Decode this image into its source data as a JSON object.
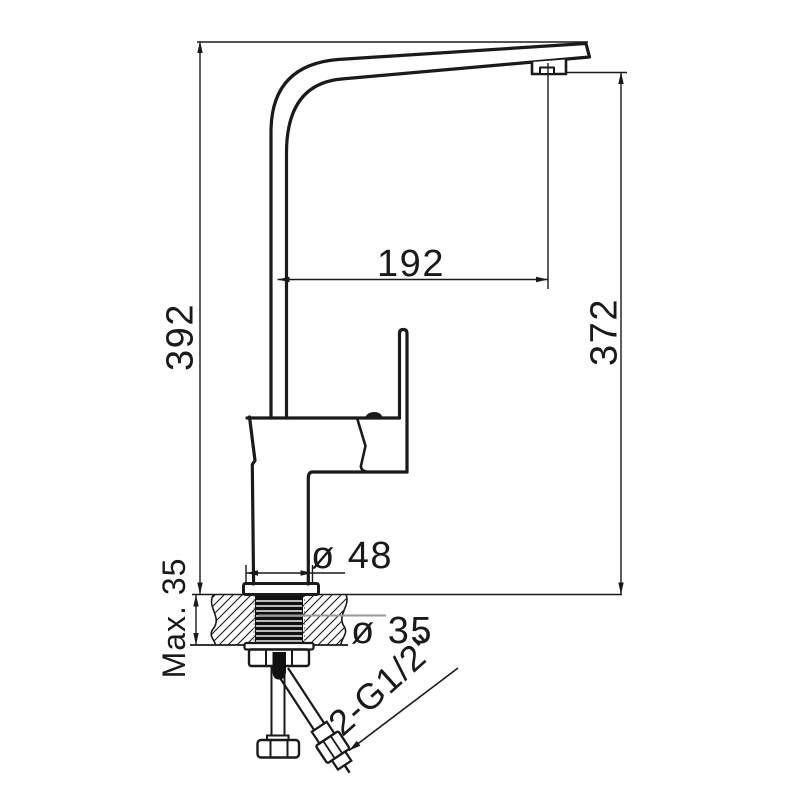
{
  "drawing": {
    "type": "technical-dimension-drawing",
    "subject": "kitchen sink mixer tap, side elevation with countertop mounting section",
    "units": "mm",
    "colors": {
      "line": "#1a1a1a",
      "leader": "#9a9a9a",
      "background": "#ffffff"
    },
    "labels": {
      "overall_height": "392",
      "spout_outlet_height": "372",
      "spout_reach": "192",
      "base_diameter": "ø 48",
      "max_deck_thickness": "Max. 35",
      "hole_diameter": "ø 35",
      "hose_connection": "2-G1/2\""
    }
  }
}
